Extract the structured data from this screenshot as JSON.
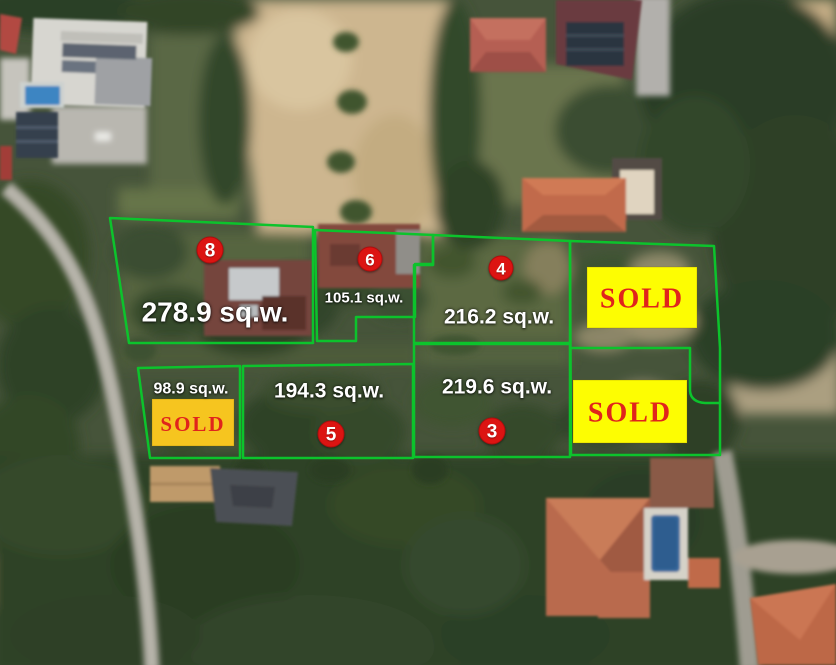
{
  "colors": {
    "boundary_green": "#0cc32c",
    "marker_red": "#dc1412",
    "marker_number": "#ffffff",
    "area_label": "#ffffff",
    "sold_text_red": "#e0241c",
    "sold_bg_yellow": "#fdfd02",
    "sold_bg_gold": "#f6c51f"
  },
  "plots": [
    {
      "number": "8",
      "area_label": "278.9 sq.w."
    },
    {
      "number": "6",
      "area_label": "105.1 sq.w."
    },
    {
      "number": "4",
      "area_label": "216.2 sq.w."
    },
    {
      "area_label": "98.9 sq.w.",
      "status": "SOLD"
    },
    {
      "number": "5",
      "area_label": "194.3 sq.w."
    },
    {
      "number": "3",
      "area_label": "219.6 sq.w."
    },
    {
      "status": "SOLD"
    },
    {
      "status": "SOLD"
    }
  ]
}
